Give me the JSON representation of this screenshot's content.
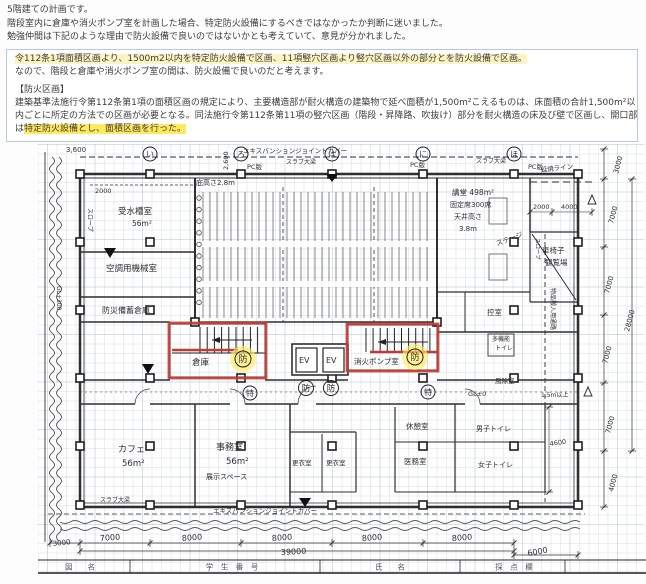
{
  "intro": {
    "lines": [
      "5階建ての計画です。",
      "階段室内に倉庫や消火ポンプ室を計画した場合、特定防火設備にするべきではなかったか判断に迷いました。",
      "勉強仲間は下記のような理由で防火設備で良いのではないかとも考えていて、意見が分かれました。"
    ]
  },
  "note_box": {
    "line1": "令112条1項面積区画より、1500m2以内を特定防火設備で区画、11項竪穴区画より竪穴区画以外の部分とを防火設備で区画。",
    "line2": "なので、階段と倉庫や消火ポンプ室の間は、防火設備で良いのだと考えます。",
    "heading": "【防火区画】",
    "body1": "建築基準法施行令第112条第1項の面積区画の規定により、主要構造部が耐火構造の建築物で延べ面積が1,500m²こえるものは、床面積の合計1,500m²以",
    "body2": "内ごとに所定の方法での区画が必要となる。同法施行令第112条第11項の竪穴区画（階段・昇降路、吹抜け）部分を耐火構造の床及び壁で区画し、開口部",
    "body3_prefix": "は",
    "body3_highlight": "特定防火設備とし、面積区画を行った。"
  },
  "colors": {
    "red_marker": "#c23a35",
    "yellow_marker": "#ffe95e",
    "pencil": "#2f2f2f",
    "grid": "#ccd7e2"
  },
  "plan": {
    "labels": [
      {
        "t": "3,600",
        "x": 66,
        "y": 150,
        "s": 7
      },
      {
        "t": "エキスパンションジョイントカバー",
        "x": 243,
        "y": 151,
        "s": 6.5
      },
      {
        "t": "2,600",
        "x": 228,
        "y": 168,
        "s": 6.5,
        "r": -90
      },
      {
        "t": "庇高さ2.8m",
        "x": 196,
        "y": 183,
        "s": 7
      },
      {
        "t": "PC版",
        "x": 247,
        "y": 167,
        "s": 6.5
      },
      {
        "t": "スラブ大梁",
        "x": 286,
        "y": 162,
        "s": 6
      },
      {
        "t": "PC版",
        "x": 410,
        "y": 165,
        "s": 6.5
      },
      {
        "t": "スラブ大梁",
        "x": 476,
        "y": 161,
        "s": 6
      },
      {
        "t": "PC版",
        "x": 528,
        "y": 167,
        "s": 6.5
      },
      {
        "t": "延焼ライン",
        "x": 541,
        "y": 170,
        "s": 6.5,
        "r": -6
      },
      {
        "t": "2000",
        "x": 533,
        "y": 207,
        "s": 6.5
      },
      {
        "t": "4000",
        "x": 561,
        "y": 207,
        "s": 6.5
      },
      {
        "t": "2000",
        "x": 95,
        "y": 191,
        "s": 6.5
      },
      {
        "t": "スロープ",
        "x": 88,
        "y": 206,
        "s": 6,
        "r": 90
      },
      {
        "t": "GL+300",
        "x": 57,
        "y": 284,
        "s": 6,
        "r": 90
      },
      {
        "t": "受水槽室",
        "x": 118,
        "y": 212,
        "s": 8.5
      },
      {
        "t": "56m²",
        "x": 132,
        "y": 224,
        "s": 7.5
      },
      {
        "t": "空調用機械室",
        "x": 106,
        "y": 269,
        "s": 8.5
      },
      {
        "t": "防災備蓄倉庫",
        "x": 102,
        "y": 311,
        "s": 8
      },
      {
        "t": "倉庫",
        "x": 192,
        "y": 363,
        "s": 8.5
      },
      {
        "t": "消火ポンプ室",
        "x": 354,
        "y": 362,
        "s": 7.5
      },
      {
        "t": "講堂 498m²",
        "x": 452,
        "y": 193,
        "s": 7.5
      },
      {
        "t": "固定席300席",
        "x": 450,
        "y": 205,
        "s": 7
      },
      {
        "t": "天井高さ",
        "x": 454,
        "y": 217,
        "s": 7
      },
      {
        "t": "3.8m",
        "x": 459,
        "y": 229,
        "s": 7
      },
      {
        "t": "ステージ",
        "x": 497,
        "y": 244,
        "s": 7,
        "r": -20
      },
      {
        "t": "車椅子",
        "x": 542,
        "y": 251,
        "s": 7.5
      },
      {
        "t": "観覧場",
        "x": 545,
        "y": 263,
        "s": 7.5
      },
      {
        "t": "控室",
        "x": 487,
        "y": 313,
        "s": 7.5
      },
      {
        "t": "多機能",
        "x": 492,
        "y": 339,
        "s": 6
      },
      {
        "t": "トイレ",
        "x": 495,
        "y": 348,
        "s": 6
      },
      {
        "t": "風除室",
        "x": 495,
        "y": 381,
        "s": 6.5
      },
      {
        "t": "GL±0",
        "x": 468,
        "y": 394,
        "s": 6.5
      },
      {
        "t": "1.5m以上",
        "x": 541,
        "y": 395,
        "s": 6
      },
      {
        "t": "スロープ",
        "x": 536,
        "y": 236,
        "s": 5.5,
        "r": 90
      },
      {
        "t": "物品搬入用通路",
        "x": 551,
        "y": 286,
        "s": 6,
        "r": 90
      },
      {
        "t": "EV",
        "x": 299,
        "y": 361,
        "s": 8
      },
      {
        "t": "EV",
        "x": 326,
        "y": 361,
        "s": 8
      },
      {
        "t": "カフェ",
        "x": 118,
        "y": 450,
        "s": 9
      },
      {
        "t": "56m²",
        "x": 122,
        "y": 464,
        "s": 8.5
      },
      {
        "t": "事務室",
        "x": 216,
        "y": 448,
        "s": 9
      },
      {
        "t": "56m²",
        "x": 226,
        "y": 462,
        "s": 8.5
      },
      {
        "t": "展示スペース",
        "x": 206,
        "y": 477,
        "s": 7
      },
      {
        "t": "更衣室",
        "x": 292,
        "y": 463,
        "s": 6.5
      },
      {
        "t": "更衣室",
        "x": 326,
        "y": 463,
        "s": 6.5
      },
      {
        "t": "休憩室",
        "x": 406,
        "y": 427,
        "s": 7.5
      },
      {
        "t": "医務室",
        "x": 404,
        "y": 462,
        "s": 7.5
      },
      {
        "t": "男子トイレ",
        "x": 476,
        "y": 429,
        "s": 7
      },
      {
        "t": "女子トイレ",
        "x": 478,
        "y": 465,
        "s": 7
      },
      {
        "t": "4600",
        "x": 550,
        "y": 444,
        "s": 6.5,
        "r": -8
      },
      {
        "t": "スラブ大梁",
        "x": 100,
        "y": 500,
        "s": 6
      },
      {
        "t": "エキスパンションジョイントカバー",
        "x": 213,
        "y": 511,
        "s": 6.5
      },
      {
        "t": "3000",
        "x": 53,
        "y": 544,
        "s": 7,
        "r": -6
      },
      {
        "t": "7000",
        "x": 100,
        "y": 539,
        "s": 8,
        "r": -4
      },
      {
        "t": "8000",
        "x": 182,
        "y": 539,
        "s": 8,
        "r": -4
      },
      {
        "t": "8000",
        "x": 272,
        "y": 539,
        "s": 8,
        "r": -4
      },
      {
        "t": "8000",
        "x": 362,
        "y": 539,
        "s": 8,
        "r": -4
      },
      {
        "t": "8000",
        "x": 452,
        "y": 539,
        "s": 8,
        "r": -4
      },
      {
        "t": "39000",
        "x": 281,
        "y": 553,
        "s": 8,
        "r": -3
      },
      {
        "t": "6000",
        "x": 528,
        "y": 554,
        "s": 8,
        "r": -10
      },
      {
        "t": "3000",
        "x": 618,
        "y": 172,
        "s": 7,
        "r": -75
      },
      {
        "t": "7000",
        "x": 613,
        "y": 222,
        "s": 7,
        "r": -75
      },
      {
        "t": "7000",
        "x": 609,
        "y": 292,
        "s": 7,
        "r": -75
      },
      {
        "t": "28000",
        "x": 629,
        "y": 330,
        "s": 7,
        "r": -75
      },
      {
        "t": "7000",
        "x": 607,
        "y": 362,
        "s": 7,
        "r": -75
      },
      {
        "t": "7000",
        "x": 610,
        "y": 432,
        "s": 7,
        "r": -75
      },
      {
        "t": "4000",
        "x": 613,
        "y": 490,
        "s": 7,
        "r": -75
      }
    ],
    "circles": [
      {
        "t": "い",
        "x": 150,
        "y": 152,
        "r2": 7
      },
      {
        "t": "ろ",
        "x": 241,
        "y": 152,
        "r2": 7
      },
      {
        "t": "は",
        "x": 332,
        "y": 152,
        "r2": 7
      },
      {
        "t": "に",
        "x": 423,
        "y": 152,
        "r2": 7
      },
      {
        "t": "ほ",
        "x": 514,
        "y": 152,
        "r2": 7
      },
      {
        "t": "防",
        "x": 306,
        "y": 386,
        "r2": 7.5
      },
      {
        "t": "防",
        "x": 331,
        "y": 386,
        "r2": 7.5
      },
      {
        "t": "防",
        "x": 243,
        "y": 357,
        "r2": 8,
        "hl": true
      },
      {
        "t": "防",
        "x": 415,
        "y": 355,
        "r2": 8,
        "hl": true
      },
      {
        "t": "特",
        "x": 250,
        "y": 391,
        "r2": 7
      },
      {
        "t": "特",
        "x": 428,
        "y": 390,
        "r2": 7
      }
    ],
    "footer": [
      {
        "t": "図　　名",
        "x": 80
      },
      {
        "t": "学　生　番　号",
        "x": 232
      },
      {
        "t": "氏　　名",
        "x": 390
      },
      {
        "t": "採　点　欄",
        "x": 514
      }
    ]
  }
}
